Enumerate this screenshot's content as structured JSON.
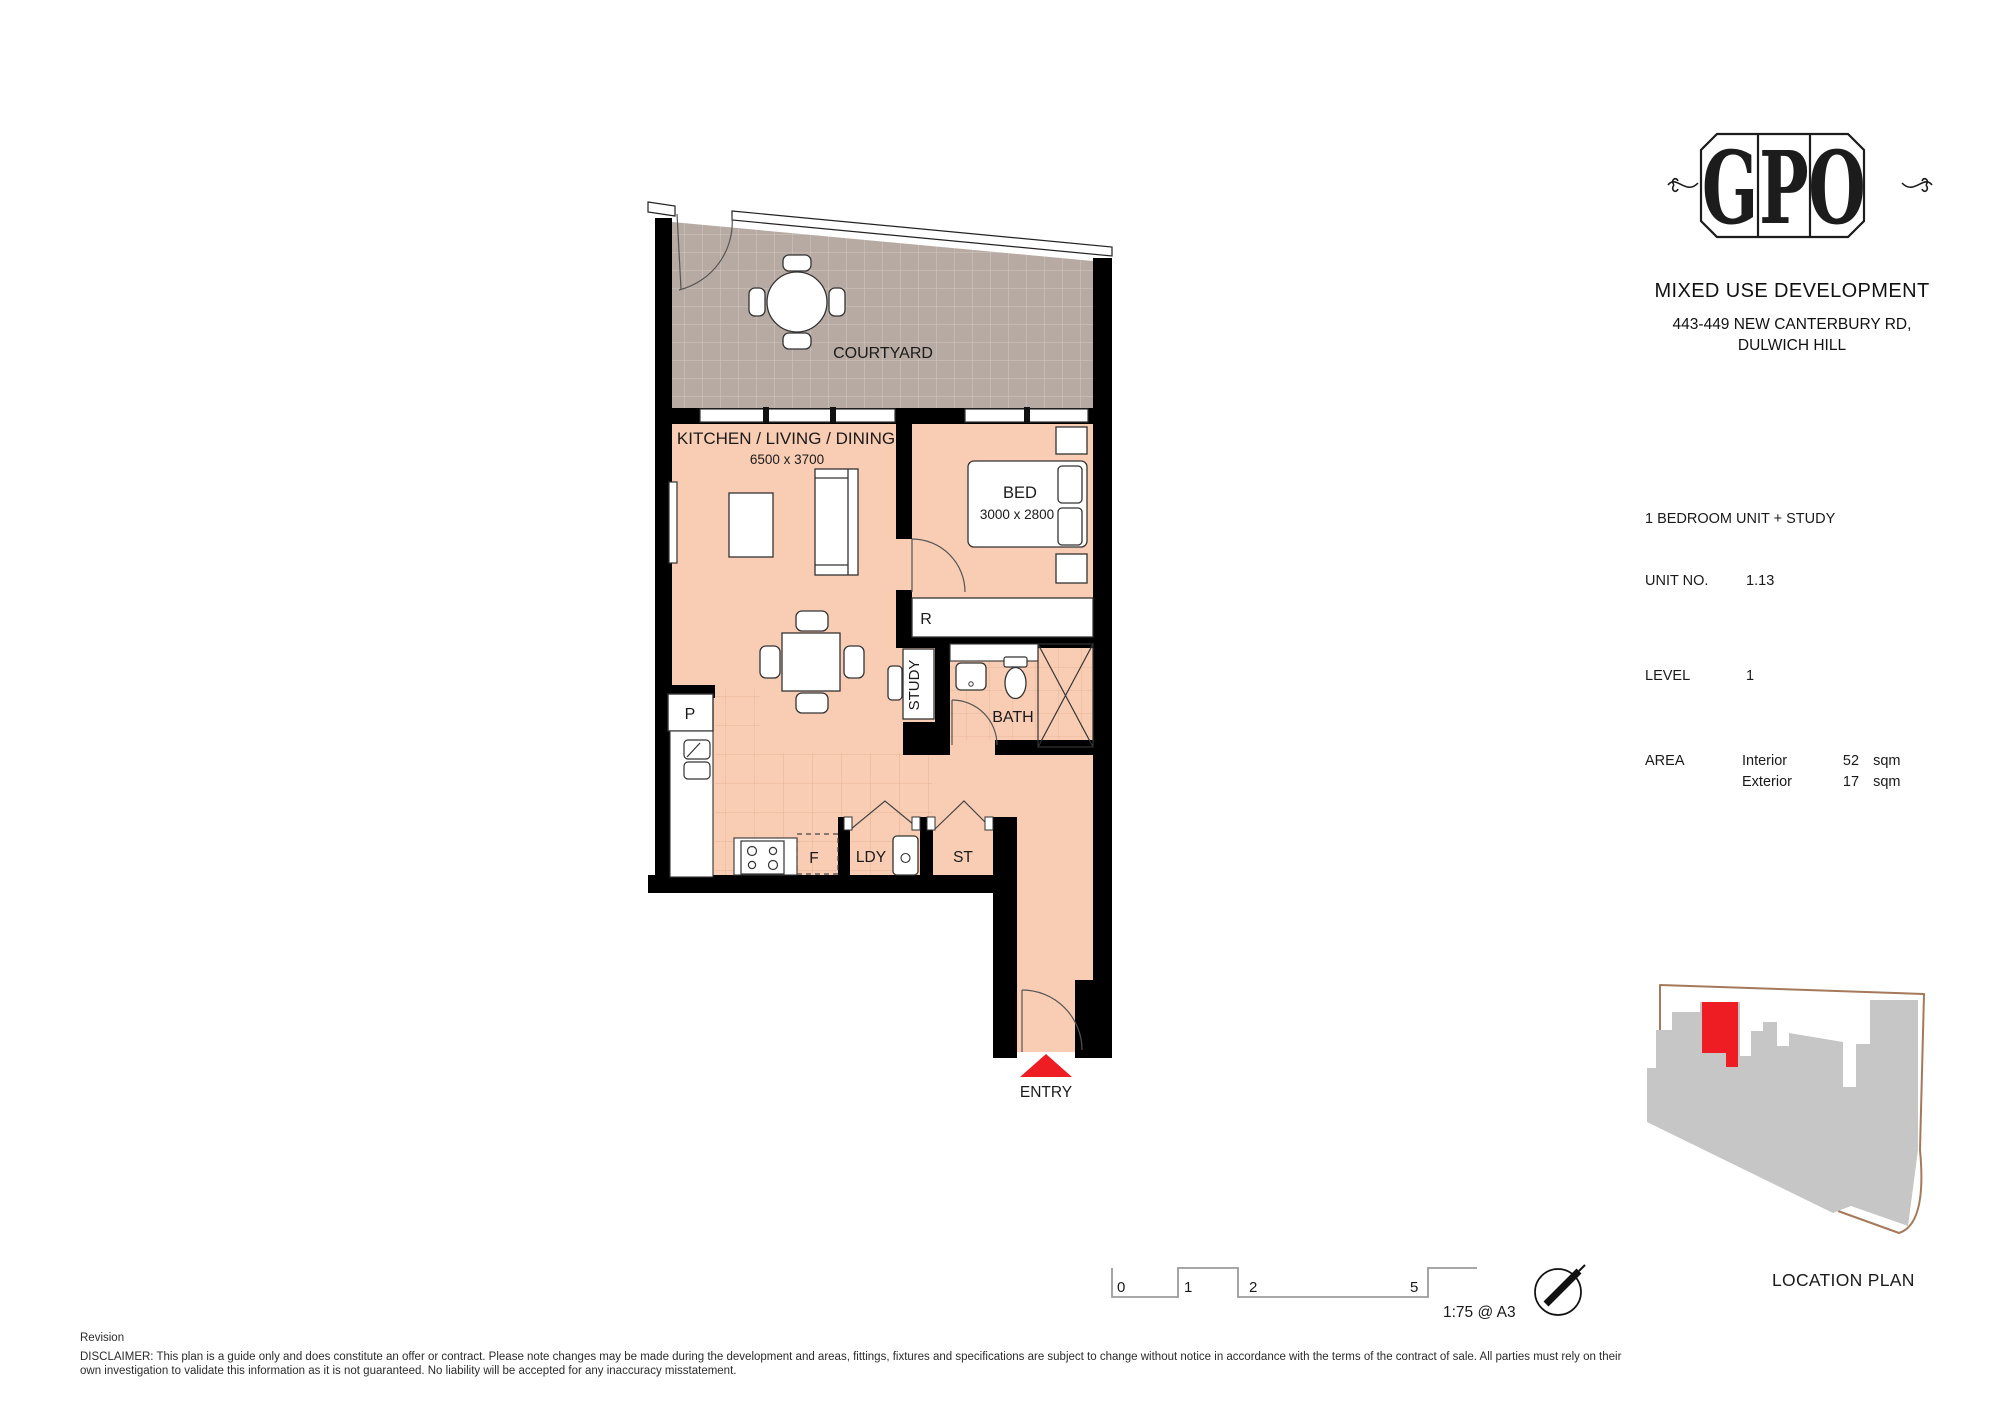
{
  "title_block": {
    "logo_letters": [
      "G",
      "P",
      "O"
    ],
    "project": "MIXED USE DEVELOPMENT",
    "address_line1": "443-449 NEW CANTERBURY RD,",
    "address_line2": "DULWICH HILL"
  },
  "unit_details": {
    "unit_type": "1 BEDROOM UNIT + STUDY",
    "unit_no_label": "UNIT NO.",
    "unit_no_value": "1.13",
    "level_label": "LEVEL",
    "level_value": "1",
    "area_label": "AREA",
    "area_rows": [
      {
        "label": "Interior",
        "value": "52",
        "unit": "sqm"
      },
      {
        "label": "Exterior",
        "value": "17",
        "unit": "sqm"
      }
    ]
  },
  "plan": {
    "labels": {
      "courtyard": "COURTYARD",
      "kitchen_living_dining": "KITCHEN / LIVING / DINING",
      "kitchen_living_dining_dims": "6500 x 3700",
      "bed": "BED",
      "bed_dims": "3000 x 2800",
      "robe": "R",
      "study": "STUDY",
      "bath": "BATH",
      "pantry": "P",
      "fridge": "F",
      "laundry": "LDY",
      "store": "ST",
      "entry": "ENTRY"
    }
  },
  "scale_bar": {
    "ticks": [
      "0",
      "1",
      "2",
      "5"
    ],
    "scale_text": "1:75 @ A3"
  },
  "location_plan": {
    "label": "LOCATION PLAN"
  },
  "footer": {
    "revision": "Revision",
    "disclaimer_line1": "DISCLAIMER: This plan is a guide only and does constitute an offer or contract. Please note changes may be made during the development and areas, fittings, fixtures and specifications are subject to change without notice in accordance with the terms of the contract of sale. All parties must rely on their",
    "disclaimer_line2": "own investigation to validate this information as it is not guaranteed. No liability will be accepted for any inaccuracy misstatement."
  },
  "colors": {
    "wall": "#000000",
    "interior_floor": "#f9cdb4",
    "courtyard_floor": "#b7aaa2",
    "entry_marker_red": "#ee1c23",
    "location_building_grey": "#c6c6c6",
    "location_boundary_tan": "#a5795a"
  }
}
